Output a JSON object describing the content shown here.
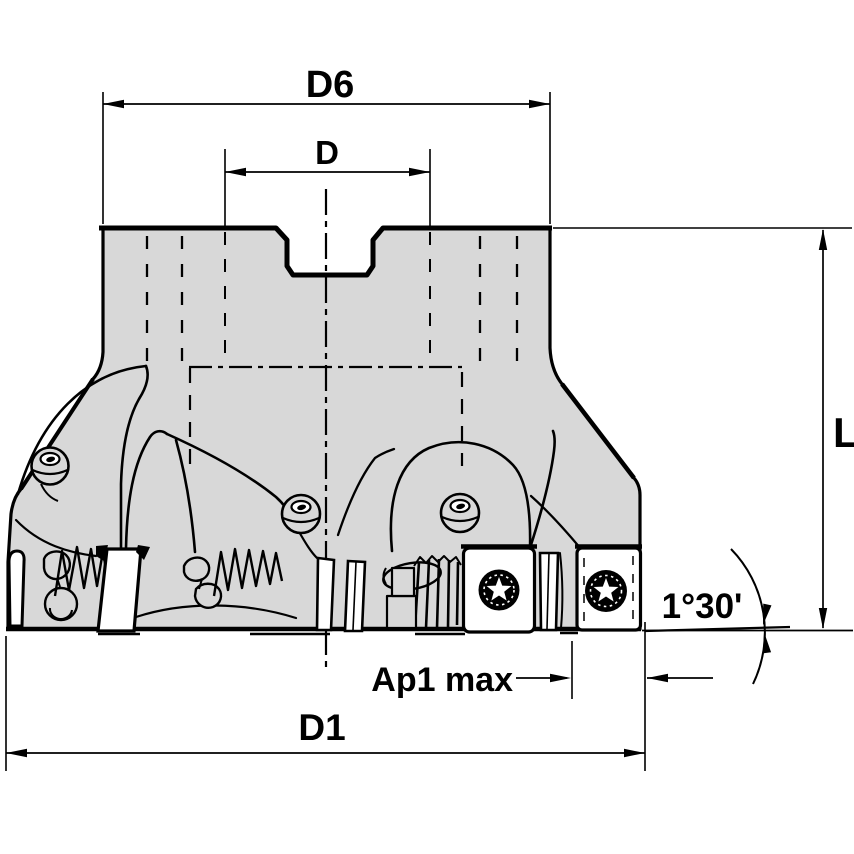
{
  "drawing": {
    "type": "engineering-dimension-drawing",
    "subject": "Indexable face milling cutter, side elevation with dimension callouts",
    "labels": {
      "d6": "D6",
      "d": "D",
      "l": "L",
      "d1": "D1",
      "ap1_max": "Ap1 max",
      "lead_angle": "1°30'"
    },
    "colors": {
      "background": "#ffffff",
      "body_fill": "#d8d8d8",
      "insert_fill": "#ffffff",
      "line": "#000000"
    }
  }
}
